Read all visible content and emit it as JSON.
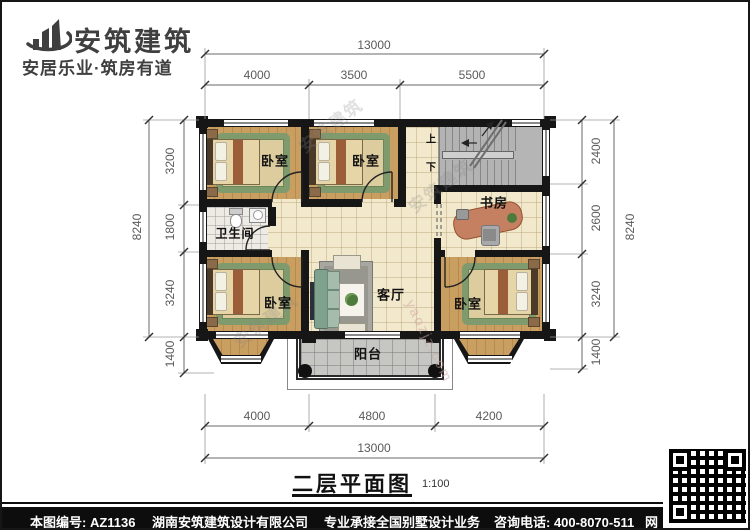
{
  "header": {
    "brand": "安筑建筑",
    "tagline": "安居乐业·筑房有道"
  },
  "labels": {
    "bedroom": "卧室",
    "study": "书房",
    "bathroom": "卫生间",
    "living": "客厅",
    "balcony": "阳台",
    "stair_up": "上",
    "stair_down": "下"
  },
  "dims": {
    "top_total": "13000",
    "top_segments": [
      "4000",
      "3500",
      "5500"
    ],
    "bottom_segments": [
      "4000",
      "4800",
      "4200"
    ],
    "bottom_total": "13000",
    "left_total": "8240",
    "left_segments": [
      "3200",
      "1800",
      "3240",
      "1400"
    ],
    "right_total": "8240",
    "right_segments": [
      "2400",
      "2600",
      "3240",
      "1400"
    ]
  },
  "title": {
    "text": "二层平面图",
    "scale": "1:100"
  },
  "footer": {
    "drawing_no": "本图编号: AZ1136",
    "company": "湖南安筑建筑设计有限公司",
    "service": "专业承接全国别墅设计业务",
    "phone": "咨询电话: 400-8070-511",
    "web": "网"
  },
  "watermarks": {
    "brand": "安筑建筑",
    "site": "yaozjz.com"
  },
  "colors": {
    "wall": "#161616",
    "wood": "#c99e61",
    "hall_tile": "#f2e8cb",
    "stair_gray": "#b5b5b5",
    "rug_green": "#7f9a6d",
    "desk_salmon": "#c48060",
    "sofa_green": "#7fa28f",
    "footer_bg": "#0d0d0d"
  }
}
